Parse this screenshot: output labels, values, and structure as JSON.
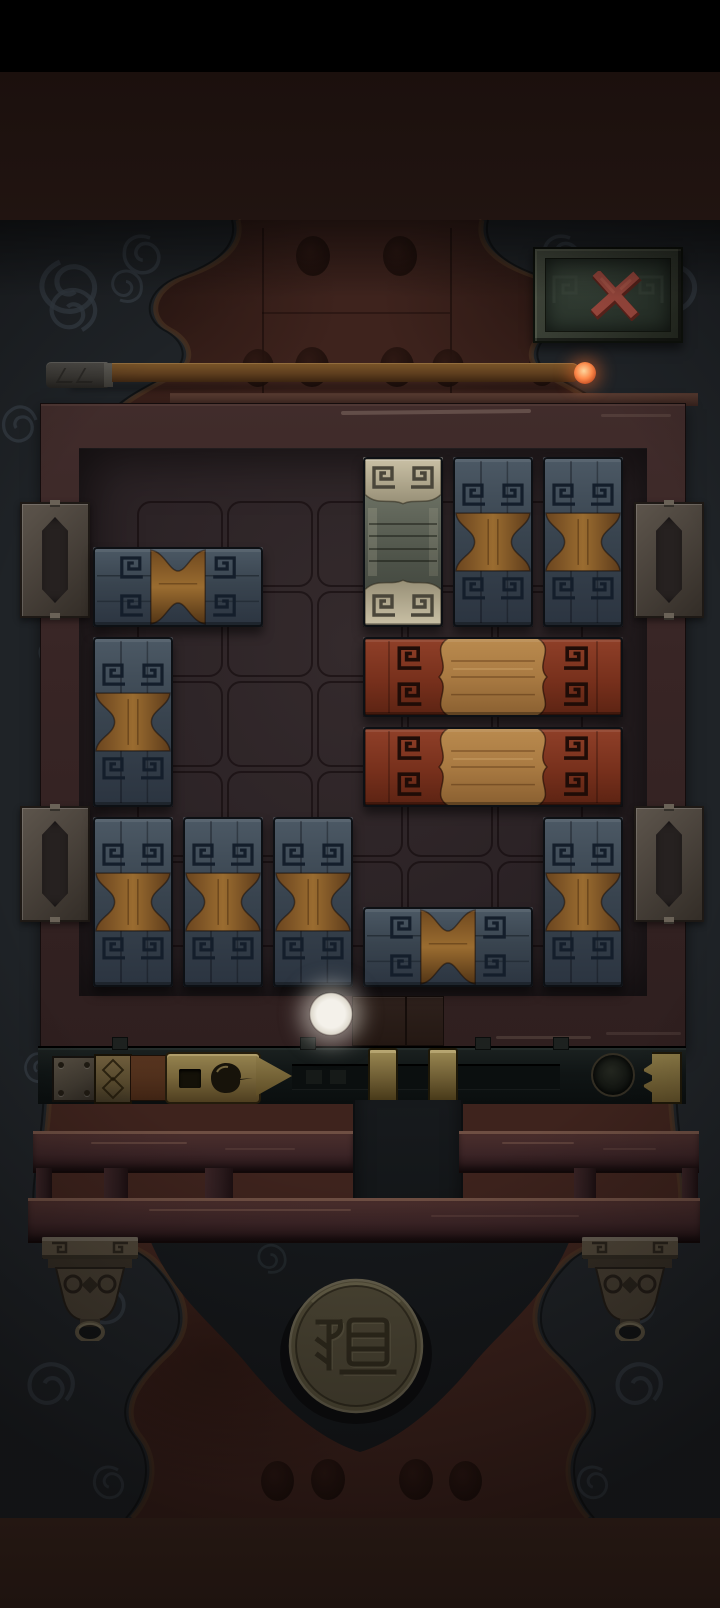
{
  "meta": {
    "screen_width": 720,
    "screen_height": 1608,
    "scene": "wooden sliding-block klotski puzzle on a carved table"
  },
  "colors": {
    "wall": "#3e231d",
    "drape": "#1f2327",
    "drape_swirl": "#353c45",
    "drape_trim": "#4a3322",
    "frame_wood": "#3a2726",
    "board_bg": "#2d2427",
    "socket_line": "#100a0c",
    "blue_cap": "#44515d",
    "blue_glyph": "#141e2b",
    "blue_wood": "#96682e",
    "red_cap": "#8a3a25",
    "red_glyph": "#1f0c07",
    "red_wood": "#b28349",
    "stone_cap": "#c6bda1",
    "stone_glyph": "#4a463a",
    "stone_center": "#5c6156",
    "brass": "#8c7a4a",
    "bar_metal": "#101616",
    "rail_wood": "#3f2728",
    "bronze": "#4c4336",
    "close_x": "#a14b40",
    "ember": "#ff8a4a",
    "hint_glow": "#efece6",
    "medallion_face": "#4e4836"
  },
  "close_button": {
    "icon": "x-icon",
    "label": "close"
  },
  "timer": {
    "kind": "incense-stick",
    "label": "burning incense timer",
    "ember_position": "right end"
  },
  "board": {
    "cols": 6,
    "rows": 6,
    "cell": 90,
    "origin_x": 88,
    "origin_y": 452,
    "pieces": [
      {
        "id": "stone-1",
        "type": "stone-vertical",
        "col": 3,
        "row": 0,
        "w": 1,
        "h": 2
      },
      {
        "id": "blue-v1",
        "type": "blue-vertical",
        "col": 4,
        "row": 0,
        "w": 1,
        "h": 2
      },
      {
        "id": "blue-v2",
        "type": "blue-vertical",
        "col": 5,
        "row": 0,
        "w": 1,
        "h": 2
      },
      {
        "id": "blue-h1",
        "type": "blue-horizontal",
        "col": 0,
        "row": 1,
        "w": 2,
        "h": 1
      },
      {
        "id": "blue-v3",
        "type": "blue-vertical",
        "col": 0,
        "row": 2,
        "w": 1,
        "h": 2
      },
      {
        "id": "red-h1",
        "type": "red-horizontal",
        "col": 3,
        "row": 2,
        "w": 3,
        "h": 1
      },
      {
        "id": "red-h2",
        "type": "red-horizontal",
        "col": 3,
        "row": 3,
        "w": 3,
        "h": 1
      },
      {
        "id": "blue-v4",
        "type": "blue-vertical",
        "col": 0,
        "row": 4,
        "w": 1,
        "h": 2
      },
      {
        "id": "blue-v5",
        "type": "blue-vertical",
        "col": 1,
        "row": 4,
        "w": 1,
        "h": 2
      },
      {
        "id": "blue-v6",
        "type": "blue-vertical",
        "col": 2,
        "row": 4,
        "w": 1,
        "h": 2
      },
      {
        "id": "blue-h2",
        "type": "blue-horizontal",
        "col": 3,
        "row": 5,
        "w": 2,
        "h": 1
      },
      {
        "id": "blue-v7",
        "type": "blue-vertical",
        "col": 5,
        "row": 4,
        "w": 1,
        "h": 2
      }
    ],
    "sockets": {
      "origin_x": 133,
      "origin_y": 497,
      "cell": 90,
      "cols": 5,
      "rows": 5
    },
    "handles": [
      {
        "x": 20,
        "y": 502
      },
      {
        "x": 20,
        "y": 806
      },
      {
        "x": 634,
        "y": 502
      },
      {
        "x": 634,
        "y": 806
      }
    ],
    "exit_blocks": [
      {
        "x": 352,
        "w": 52
      },
      {
        "x": 406,
        "w": 36
      }
    ]
  },
  "hint_dot": {
    "x": 331,
    "y": 1014
  },
  "latch": {
    "stops": [
      {
        "x": 368
      },
      {
        "x": 428
      }
    ],
    "nubs": [
      {
        "x": 112
      },
      {
        "x": 300
      },
      {
        "x": 475
      },
      {
        "x": 553
      }
    ],
    "track_slots": [
      {
        "x": 14
      },
      {
        "x": 38
      }
    ]
  },
  "shelf": {
    "rail_segments": [
      {
        "x": 33,
        "y": 1131,
        "w": 320,
        "h": 37
      },
      {
        "x": 459,
        "y": 1131,
        "w": 240,
        "h": 37
      },
      {
        "x": 28,
        "y": 1198,
        "w": 672,
        "h": 40
      }
    ],
    "posts": [
      {
        "x": 36,
        "w": 16
      },
      {
        "x": 104,
        "w": 24
      },
      {
        "x": 205,
        "w": 28
      },
      {
        "x": 574,
        "w": 22
      },
      {
        "x": 682,
        "w": 16
      }
    ],
    "feet": [
      {
        "x": 42
      },
      {
        "x": 582
      }
    ]
  },
  "medallion": {
    "seal_character": "祖",
    "cx": 356,
    "cy": 1346,
    "r": 66,
    "label": "bronze seal medallion"
  },
  "decor": {
    "wall_dots": [
      {
        "x": 296,
        "y": 236,
        "w": 34,
        "h": 40
      },
      {
        "x": 383,
        "y": 236,
        "w": 34,
        "h": 40
      },
      {
        "x": 242,
        "y": 349,
        "w": 32,
        "h": 38
      },
      {
        "x": 295,
        "y": 347,
        "w": 34,
        "h": 40
      },
      {
        "x": 380,
        "y": 347,
        "w": 34,
        "h": 40
      },
      {
        "x": 432,
        "y": 349,
        "w": 32,
        "h": 38
      },
      {
        "x": 528,
        "y": 352,
        "w": 28,
        "h": 34
      },
      {
        "x": 614,
        "y": 350,
        "w": 30,
        "h": 36
      },
      {
        "x": 261,
        "y": 1461,
        "w": 33,
        "h": 40
      },
      {
        "x": 311,
        "y": 1459,
        "w": 34,
        "h": 41
      },
      {
        "x": 399,
        "y": 1459,
        "w": 34,
        "h": 41
      },
      {
        "x": 449,
        "y": 1461,
        "w": 33,
        "h": 40
      },
      {
        "x": 58,
        "y": 1272,
        "w": 30,
        "h": 35
      },
      {
        "x": 632,
        "y": 1272,
        "w": 30,
        "h": 35
      }
    ],
    "swirls": [
      {
        "x": 60,
        "y": 262,
        "s": 1.7,
        "r": -15
      },
      {
        "x": 150,
        "y": 238,
        "s": 1.2,
        "r": 30
      },
      {
        "x": 82,
        "y": 330,
        "s": 1.4,
        "r": 160
      },
      {
        "x": 36,
        "y": 420,
        "s": 1.1,
        "r": 80
      },
      {
        "x": 120,
        "y": 300,
        "s": 1.0,
        "r": 210
      },
      {
        "x": 55,
        "y": 640,
        "s": 0.9,
        "r": 10
      },
      {
        "x": 42,
        "y": 860,
        "s": 0.9,
        "r": 190
      },
      {
        "x": 50,
        "y": 1060,
        "s": 0.9,
        "r": 60
      },
      {
        "x": 95,
        "y": 1290,
        "s": 1.2,
        "r": -30
      },
      {
        "x": 66,
        "y": 1400,
        "s": 1.4,
        "r": 140
      },
      {
        "x": 118,
        "y": 1470,
        "s": 1.0,
        "r": 40
      }
    ],
    "skirt_swirls": [
      {
        "x": 320,
        "y": 1300,
        "s": 1.2,
        "r": 0
      },
      {
        "x": 398,
        "y": 1336,
        "s": 1.0,
        "r": 120
      },
      {
        "x": 268,
        "y": 1272,
        "s": 0.9,
        "r": 200
      }
    ]
  }
}
